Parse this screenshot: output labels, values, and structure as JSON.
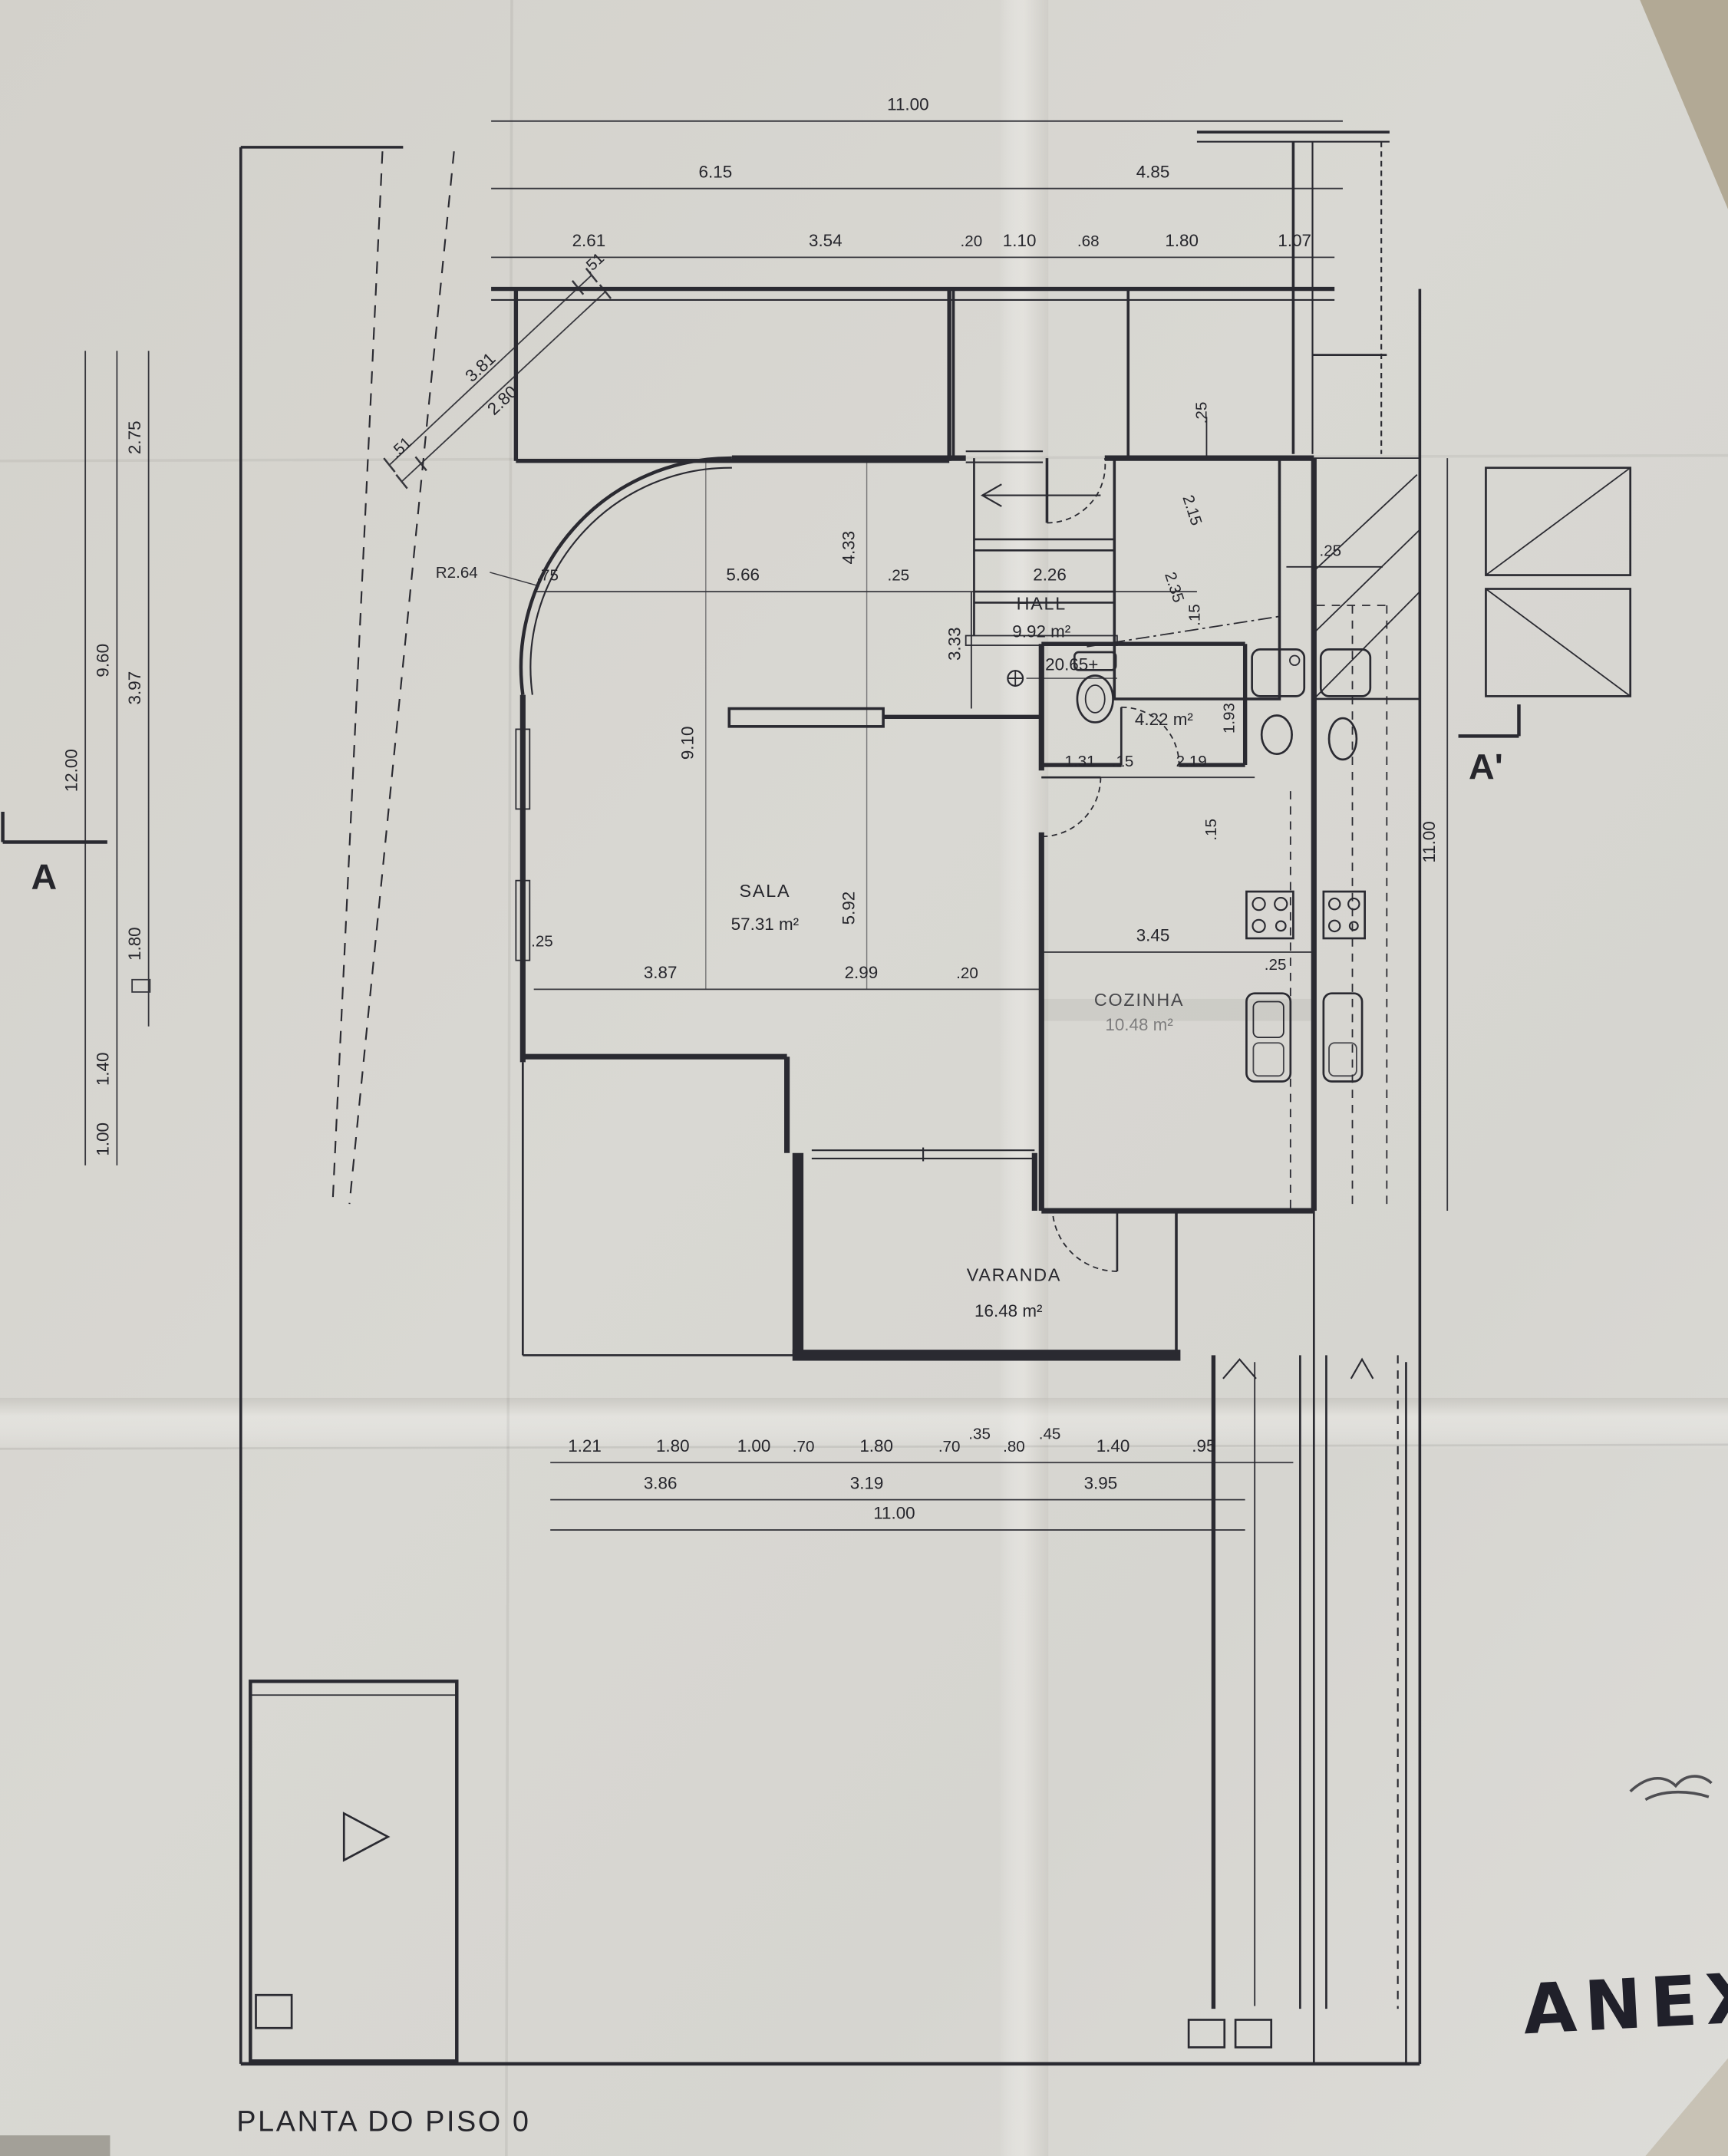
{
  "titles": {
    "plan_title": "PLANTA DO PISO 0",
    "annex_label": "ANEXO"
  },
  "rooms": {
    "hall": {
      "name": "HALL",
      "area": "9.92 m²"
    },
    "sala": {
      "name": "SALA",
      "area": "57.31 m²"
    },
    "cozinha": {
      "name": "COZINHA",
      "area": "10.48 m²"
    },
    "varanda": {
      "name": "VARANDA",
      "area": "16.48 m²"
    },
    "wc": {
      "area": "4.22 m²"
    }
  },
  "annotations": {
    "level_mark": "20.65+",
    "bay_radius": "R2.64",
    "section_left": "A",
    "section_right": "A'"
  },
  "dims": {
    "top_total": "11.00",
    "top_mid": [
      "6.15",
      "4.85"
    ],
    "top_detail": [
      "2.61",
      "3.54",
      ".20",
      "1.10",
      ".68",
      "1.80",
      "1.07"
    ],
    "left_outer": "12.00",
    "left_mid": [
      "9.60",
      "1.40",
      "1.00"
    ],
    "left_inner": [
      "2.75",
      "3.97",
      "1.80"
    ],
    "diagonal": [
      ".51",
      "3.81",
      "2.80",
      ".51"
    ],
    "interior_upper": [
      ".75",
      "5.66",
      "4.33",
      ".25",
      "2.26",
      "3.33"
    ],
    "interior_vertical": [
      "9.10",
      "5.92"
    ],
    "interior_lower": [
      ".25",
      "3.87",
      "2.99",
      ".20"
    ],
    "kitchen_row": [
      "3.45",
      ".25"
    ],
    "wc_row": [
      "1.31",
      ".15",
      "2.19"
    ],
    "wc_height": "1.93",
    "stair": [
      ".25",
      ".25",
      ".15",
      ".15",
      "2.15",
      "2.35"
    ],
    "right_total": "11.00",
    "bottom_detail": [
      "1.21",
      "1.80",
      "1.00",
      ".70",
      "1.80",
      ".70",
      ".35",
      ".80",
      ".45",
      "1.40",
      ".95"
    ],
    "bottom_mid": [
      "3.86",
      "3.19",
      "3.95"
    ],
    "bottom_total": "11.00"
  }
}
